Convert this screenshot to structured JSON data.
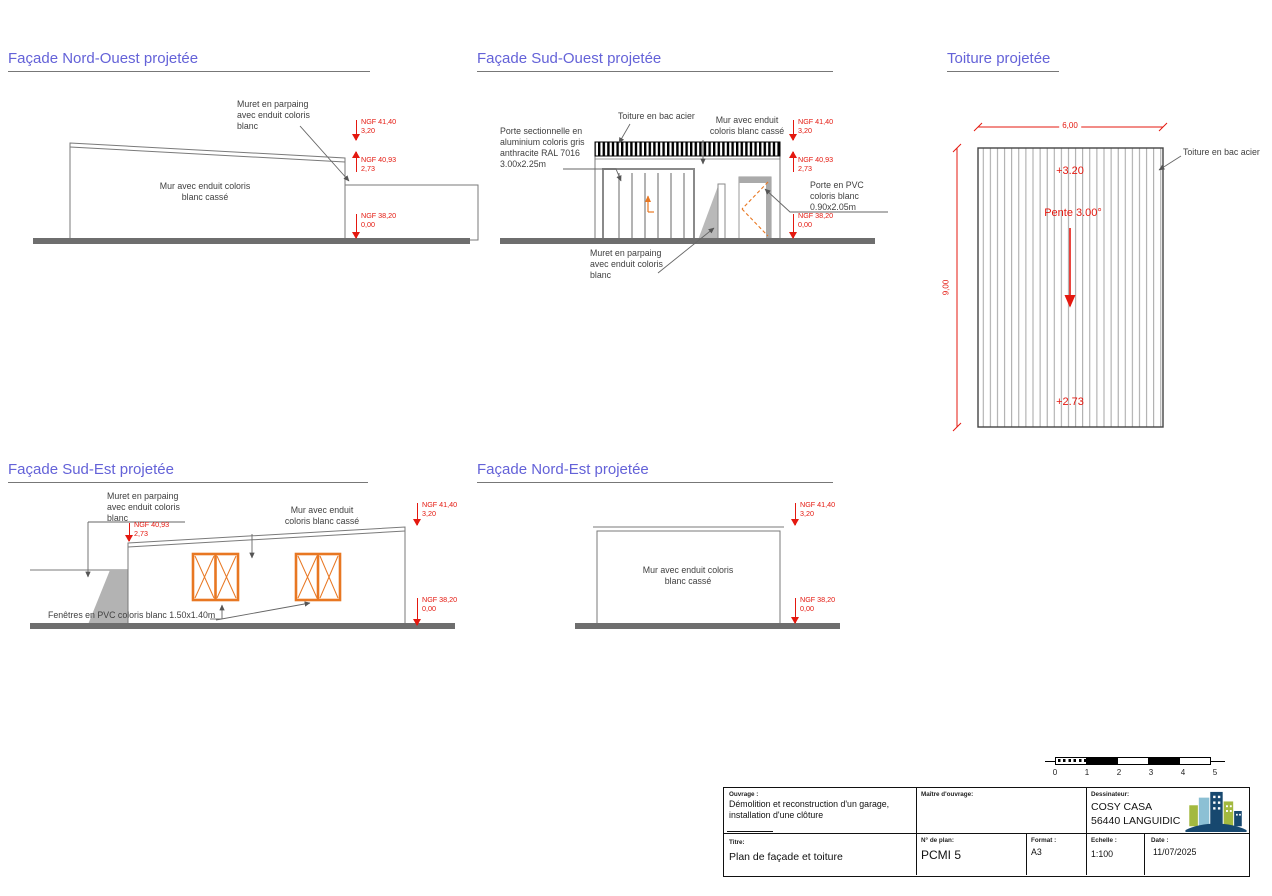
{
  "ngf": {
    "top": {
      "l1": "NGF 41,40",
      "l2": "3,20"
    },
    "mid": {
      "l1": "NGF 40,93",
      "l2": "2,73"
    },
    "ground": {
      "l1": "NGF 38,20",
      "l2": "0,00"
    }
  },
  "panels": {
    "nw": {
      "title": "Façade Nord-Ouest projetée",
      "muret_label": "Muret en parpaing\navec enduit coloris\nblanc",
      "mur_label": "Mur avec enduit coloris\nblanc cassé"
    },
    "so": {
      "title": "Façade Sud-Ouest projetée",
      "porte_sectionnelle_label": "Porte sectionnelle en\naluminium coloris gris\nanthracite RAL 7016\n3.00x2.25m",
      "toiture_label": "Toiture en bac acier",
      "mur_label": "Mur avec enduit\ncoloris blanc cassé",
      "porte_pvc_label": "Porte en PVC\ncoloris blanc\n0.90x2.05m",
      "muret_label": "Muret en parpaing\navec enduit coloris\nblanc"
    },
    "toiture": {
      "title": "Toiture projetée",
      "dim_width": "6,00",
      "dim_height": "9,00",
      "level_top": "+3.20",
      "pente": "Pente 3.00°",
      "level_bottom": "+2.73",
      "bac_acier_label": "Toiture en bac acier"
    },
    "se": {
      "title": "Façade Sud-Est projetée",
      "muret_label": "Muret en parpaing\navec enduit coloris\nblanc",
      "mur_label": "Mur avec enduit\ncoloris blanc cassé",
      "fenetres_label": "Fenêtres en PVC coloris blanc 1.50x1.40m"
    },
    "ne": {
      "title": "Façade Nord-Est projetée",
      "mur_label": "Mur avec enduit coloris\nblanc cassé"
    }
  },
  "scalebar": {
    "numbers": [
      "0",
      "1",
      "2",
      "3",
      "4",
      "5"
    ]
  },
  "titleblock": {
    "ouvrage_label": "Ouvrage :",
    "ouvrage": "Démolition et reconstruction d'un garage,\ninstallation d'une clôture",
    "maitre_label": "Maître d'ouvrage:",
    "dessinateur_label": "Dessinateur:",
    "dessinateur_name": "COSY CASA",
    "dessinateur_city": "56440 LANGUIDIC",
    "titre_label": "Titre:",
    "titre": "Plan de façade et toiture",
    "plan_label": "N° de plan:",
    "plan": "PCMI 5",
    "format_label": "Format :",
    "format": "A3",
    "echelle_label": "Echelle :",
    "echelle": "1:100",
    "date_label": "Date :",
    "date": "11/07/2025"
  },
  "colors": {
    "red": "#e4180f",
    "orange": "#e87722",
    "title_blue": "#6462d8",
    "logo_navy": "#17486f",
    "logo_green": "#a3b93f",
    "logo_light_blue": "#8cc0d4"
  }
}
